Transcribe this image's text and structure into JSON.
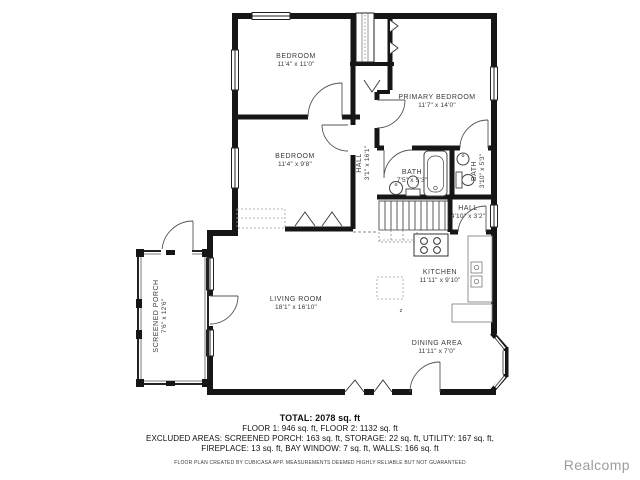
{
  "floorplan": {
    "rooms": {
      "bedroom_top": {
        "name": "BEDROOM",
        "dims": "11'4\" x 11'0\""
      },
      "bedroom_mid": {
        "name": "BEDROOM",
        "dims": "11'4\" x 9'8\""
      },
      "primary_bedroom": {
        "name": "PRIMARY BEDROOM",
        "dims": "11'7\" x 14'0\""
      },
      "hall_upper": {
        "name": "HALL",
        "dims": "3'1\" x 16'1\""
      },
      "bath_main": {
        "name": "BATH",
        "dims": "7'5\" x 5'3\""
      },
      "bath_small": {
        "name": "BATH",
        "dims": "3'10\" x 5'3\""
      },
      "hall_lower": {
        "name": "HALL",
        "dims": "4'10\" x 3'2\""
      },
      "kitchen": {
        "name": "KITCHEN",
        "dims": "11'11\" x 9'10\""
      },
      "living_room": {
        "name": "LIVING ROOM",
        "dims": "18'1\" x 16'10\""
      },
      "dining_area": {
        "name": "DINING AREA",
        "dims": "11'11\" x 7'0\""
      },
      "screened_porch": {
        "name": "SCREENED PORCH",
        "dims": "7'6\" x 12'6\""
      }
    },
    "floor_change_marker": "z",
    "summary": {
      "total": "TOTAL: 2078 sq. ft",
      "floors": "FLOOR 1: 946 sq. ft, FLOOR 2: 1132 sq. ft",
      "excluded_1": "EXCLUDED AREAS: SCREENED PORCH: 163 sq. ft, STORAGE: 22 sq. ft, UTILITY: 167 sq. ft,",
      "excluded_2": "FIREPLACE: 13 sq. ft, BAY WINDOW: 7 sq. ft, WALLS: 166 sq. ft",
      "disclaimer": "FLOOR PLAN CREATED BY CUBICASA APP. MEASUREMENTS DEEMED HIGHLY RELIABLE BUT NOT GUARANTEED"
    },
    "watermark": "Realcomp",
    "colors": {
      "wall": "#161616",
      "fixture": "#444444",
      "watermark": "#9c9c9c"
    }
  }
}
